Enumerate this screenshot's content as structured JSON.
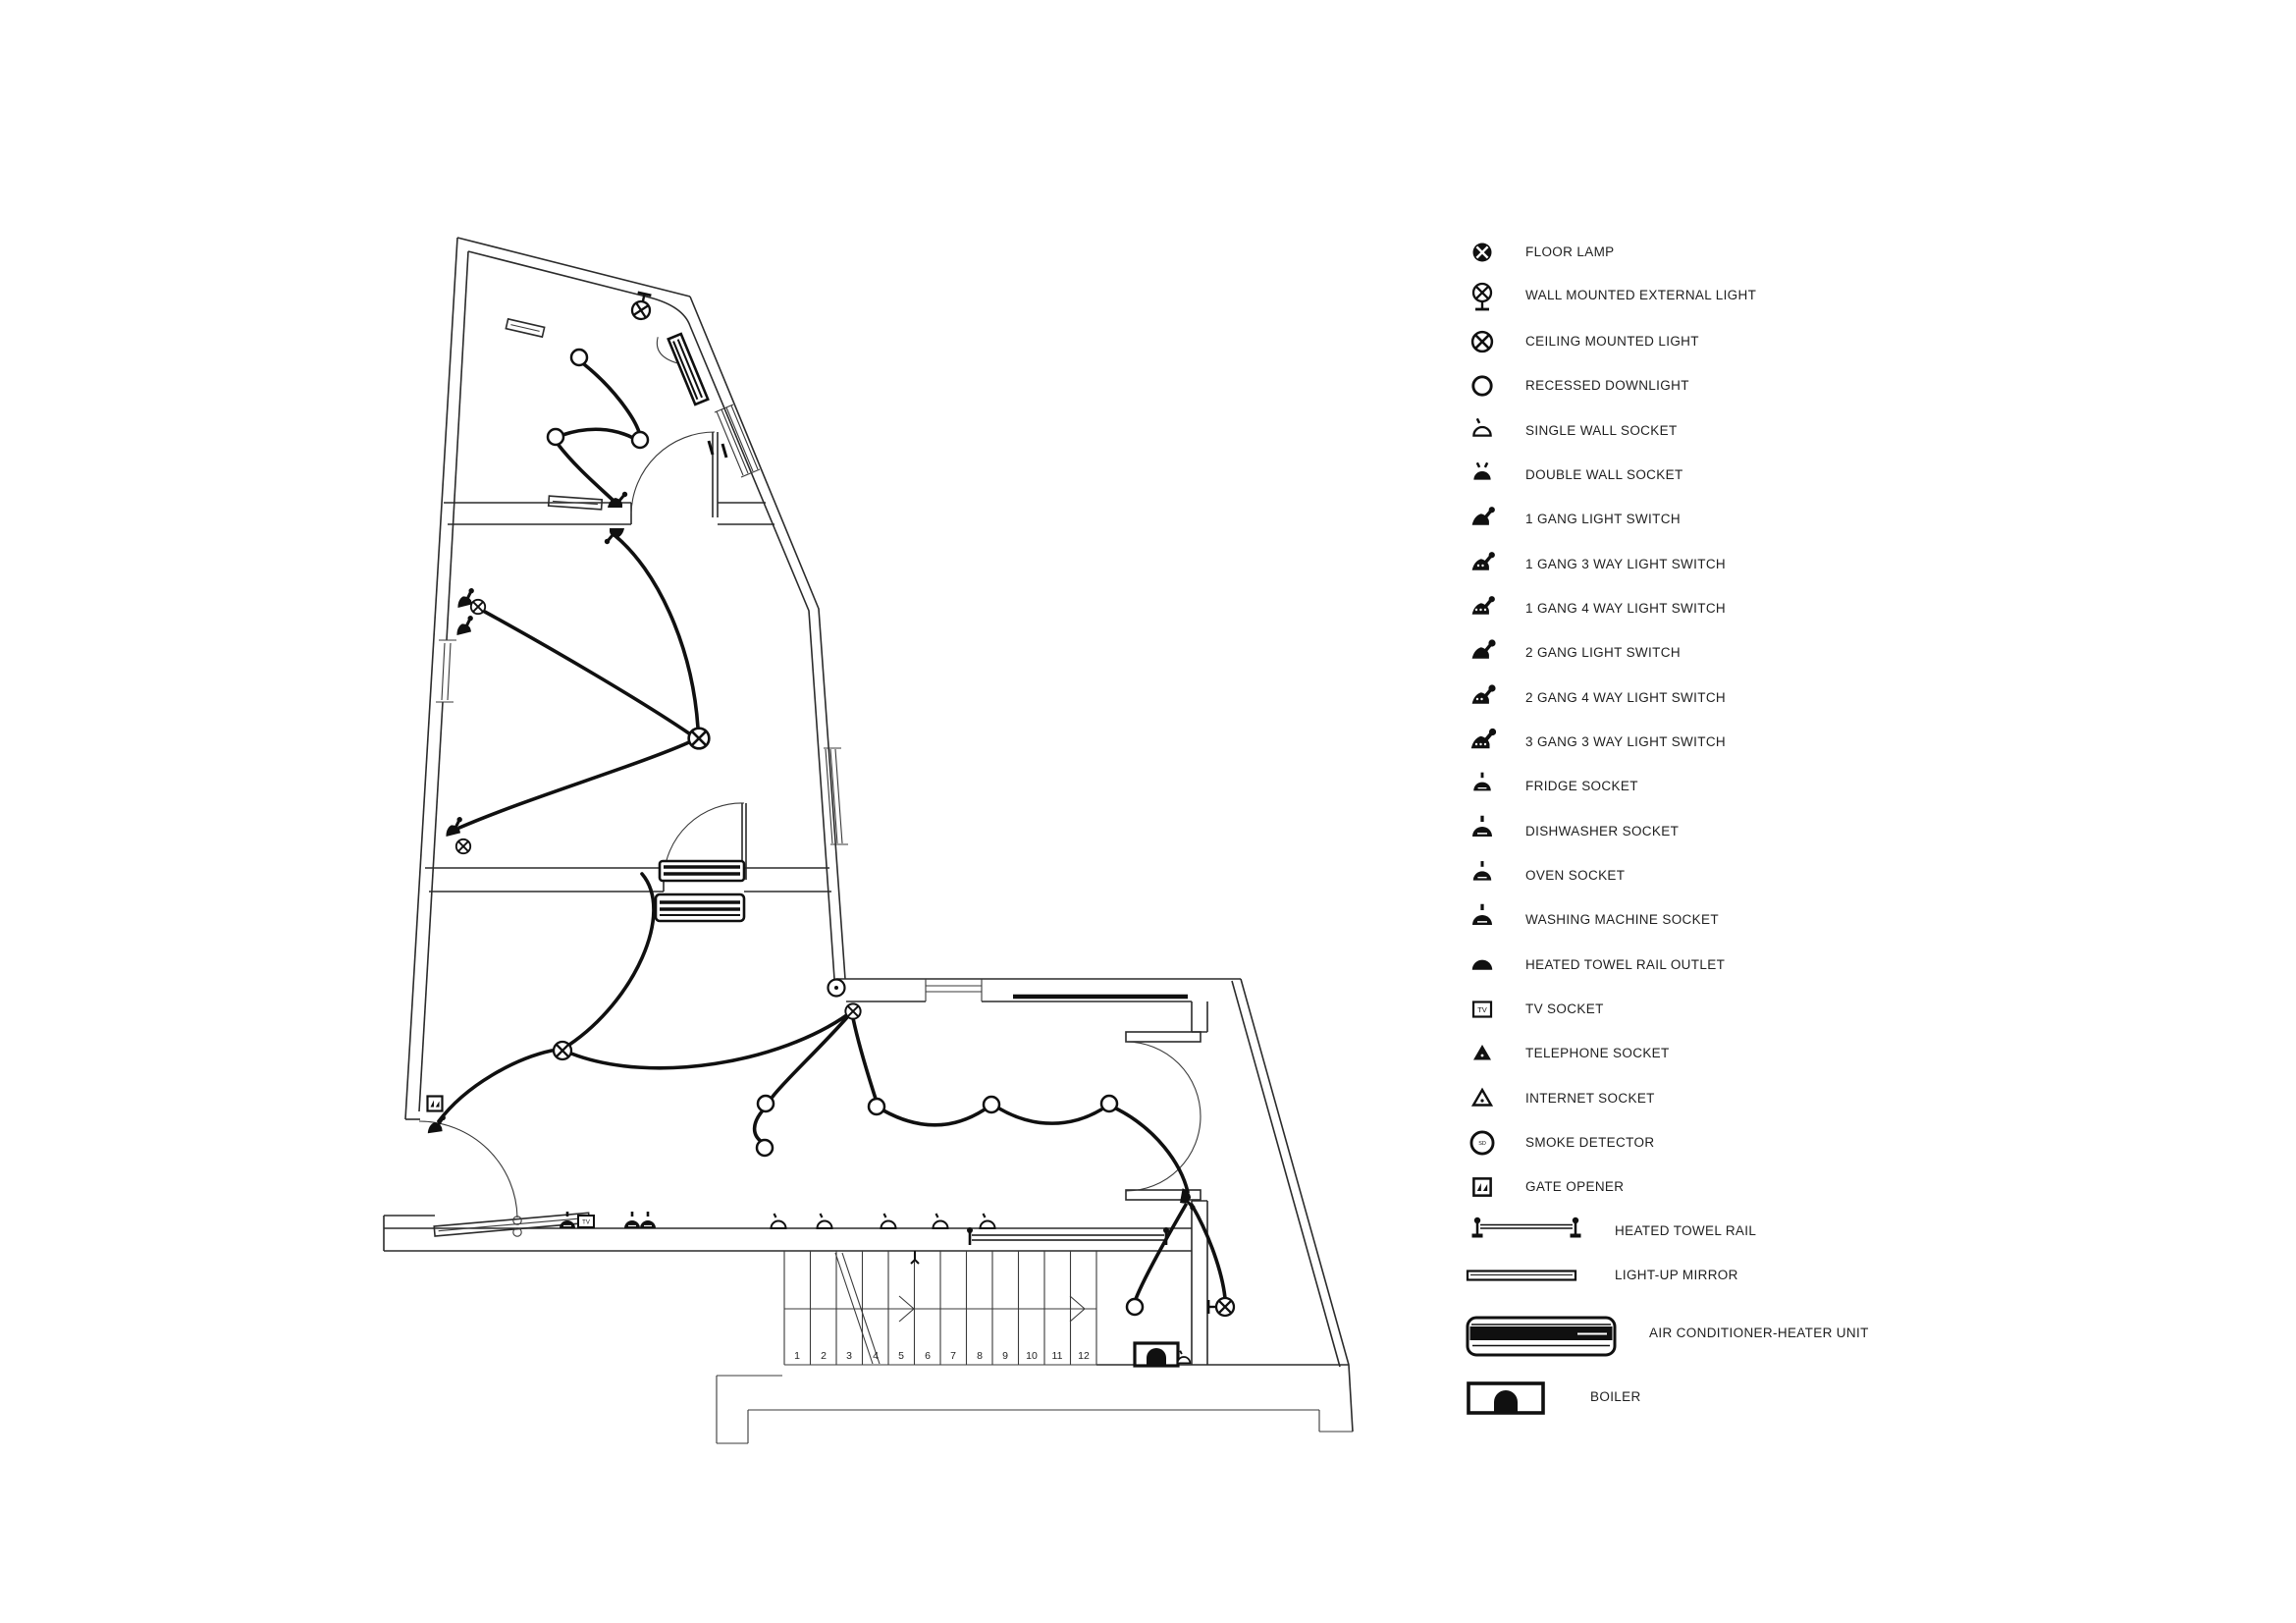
{
  "legend": {
    "items": [
      {
        "symbol": "floor-lamp",
        "label": "FLOOR LAMP"
      },
      {
        "symbol": "wall-mounted-external-light",
        "label": "WALL MOUNTED EXTERNAL LIGHT"
      },
      {
        "symbol": "ceiling-mounted-light",
        "label": "CEILING MOUNTED LIGHT"
      },
      {
        "symbol": "recessed-downlight",
        "label": "RECESSED DOWNLIGHT"
      },
      {
        "symbol": "single-wall-socket",
        "label": "SINGLE WALL SOCKET"
      },
      {
        "symbol": "double-wall-socket",
        "label": "DOUBLE WALL SOCKET"
      },
      {
        "symbol": "1-gang-light-switch",
        "label": "1 GANG LIGHT SWITCH"
      },
      {
        "symbol": "1-gang-3-way-light-switch",
        "label": "1 GANG 3 WAY LIGHT SWITCH"
      },
      {
        "symbol": "1-gang-4-way-light-switch",
        "label": "1 GANG 4 WAY LIGHT SWITCH"
      },
      {
        "symbol": "2-gang-light-switch",
        "label": "2 GANG LIGHT SWITCH"
      },
      {
        "symbol": "2-gang-4-way-light-switch",
        "label": "2 GANG 4 WAY LIGHT SWITCH"
      },
      {
        "symbol": "3-gang-3-way-light-switch",
        "label": "3 GANG 3 WAY LIGHT SWITCH"
      },
      {
        "symbol": "fridge-socket",
        "label": "FRIDGE SOCKET"
      },
      {
        "symbol": "dishwasher-socket",
        "label": "DISHWASHER SOCKET"
      },
      {
        "symbol": "oven-socket",
        "label": "OVEN SOCKET"
      },
      {
        "symbol": "washing-machine-socket",
        "label": "WASHING MACHINE SOCKET"
      },
      {
        "symbol": "heated-towel-rail-outlet",
        "label": "HEATED TOWEL RAIL OUTLET"
      },
      {
        "symbol": "tv-socket",
        "label": "TV SOCKET"
      },
      {
        "symbol": "telephone-socket",
        "label": "TELEPHONE SOCKET"
      },
      {
        "symbol": "internet-socket",
        "label": "INTERNET SOCKET"
      },
      {
        "symbol": "smoke-detector",
        "label": "SMOKE DETECTOR"
      },
      {
        "symbol": "gate-opener",
        "label": "GATE OPENER"
      },
      {
        "symbol": "heated-towel-rail",
        "label": "HEATED TOWEL RAIL"
      },
      {
        "symbol": "light-up-mirror",
        "label": "LIGHT-UP MIRROR"
      },
      {
        "symbol": "air-conditioner-heater-unit",
        "label": "AIR CONDITIONER-HEATER UNIT"
      },
      {
        "symbol": "boiler",
        "label": "BOILER"
      }
    ]
  },
  "floor_plan": {
    "stair_numbers": [
      "1",
      "2",
      "3",
      "4",
      "5",
      "6",
      "7",
      "8",
      "9",
      "10",
      "11",
      "12"
    ],
    "labels": {
      "tv_socket": "TV",
      "smoke_detector": "SD"
    }
  }
}
